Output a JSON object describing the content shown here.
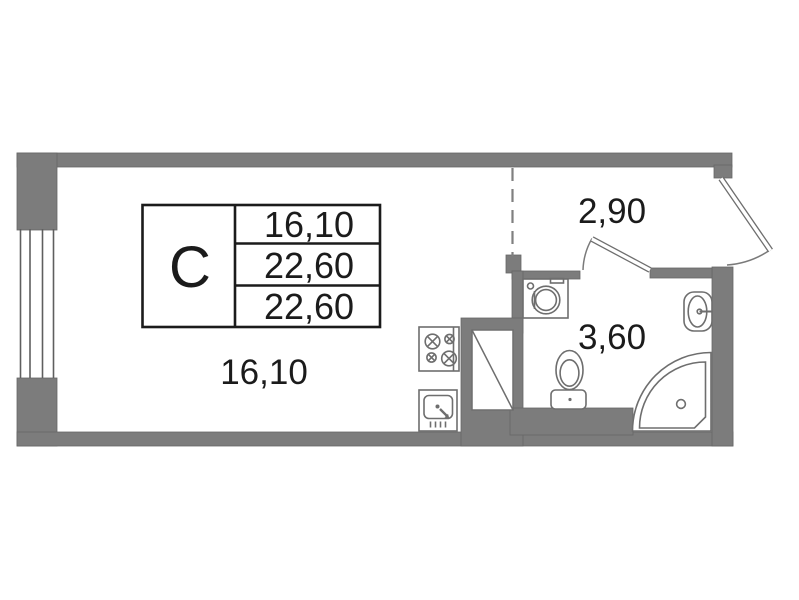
{
  "unit_card": {
    "type_label": "C",
    "rows": [
      "16,10",
      "22,60",
      "22,60"
    ]
  },
  "rooms": {
    "living": {
      "area": "16,10"
    },
    "hallway": {
      "area": "2,90"
    },
    "bathroom": {
      "area": "3,60"
    }
  },
  "colors": {
    "wall": "#7c7c7c",
    "fixture_line": "#6e6e6e",
    "text": "#1b1b1b",
    "background": "#ffffff"
  }
}
